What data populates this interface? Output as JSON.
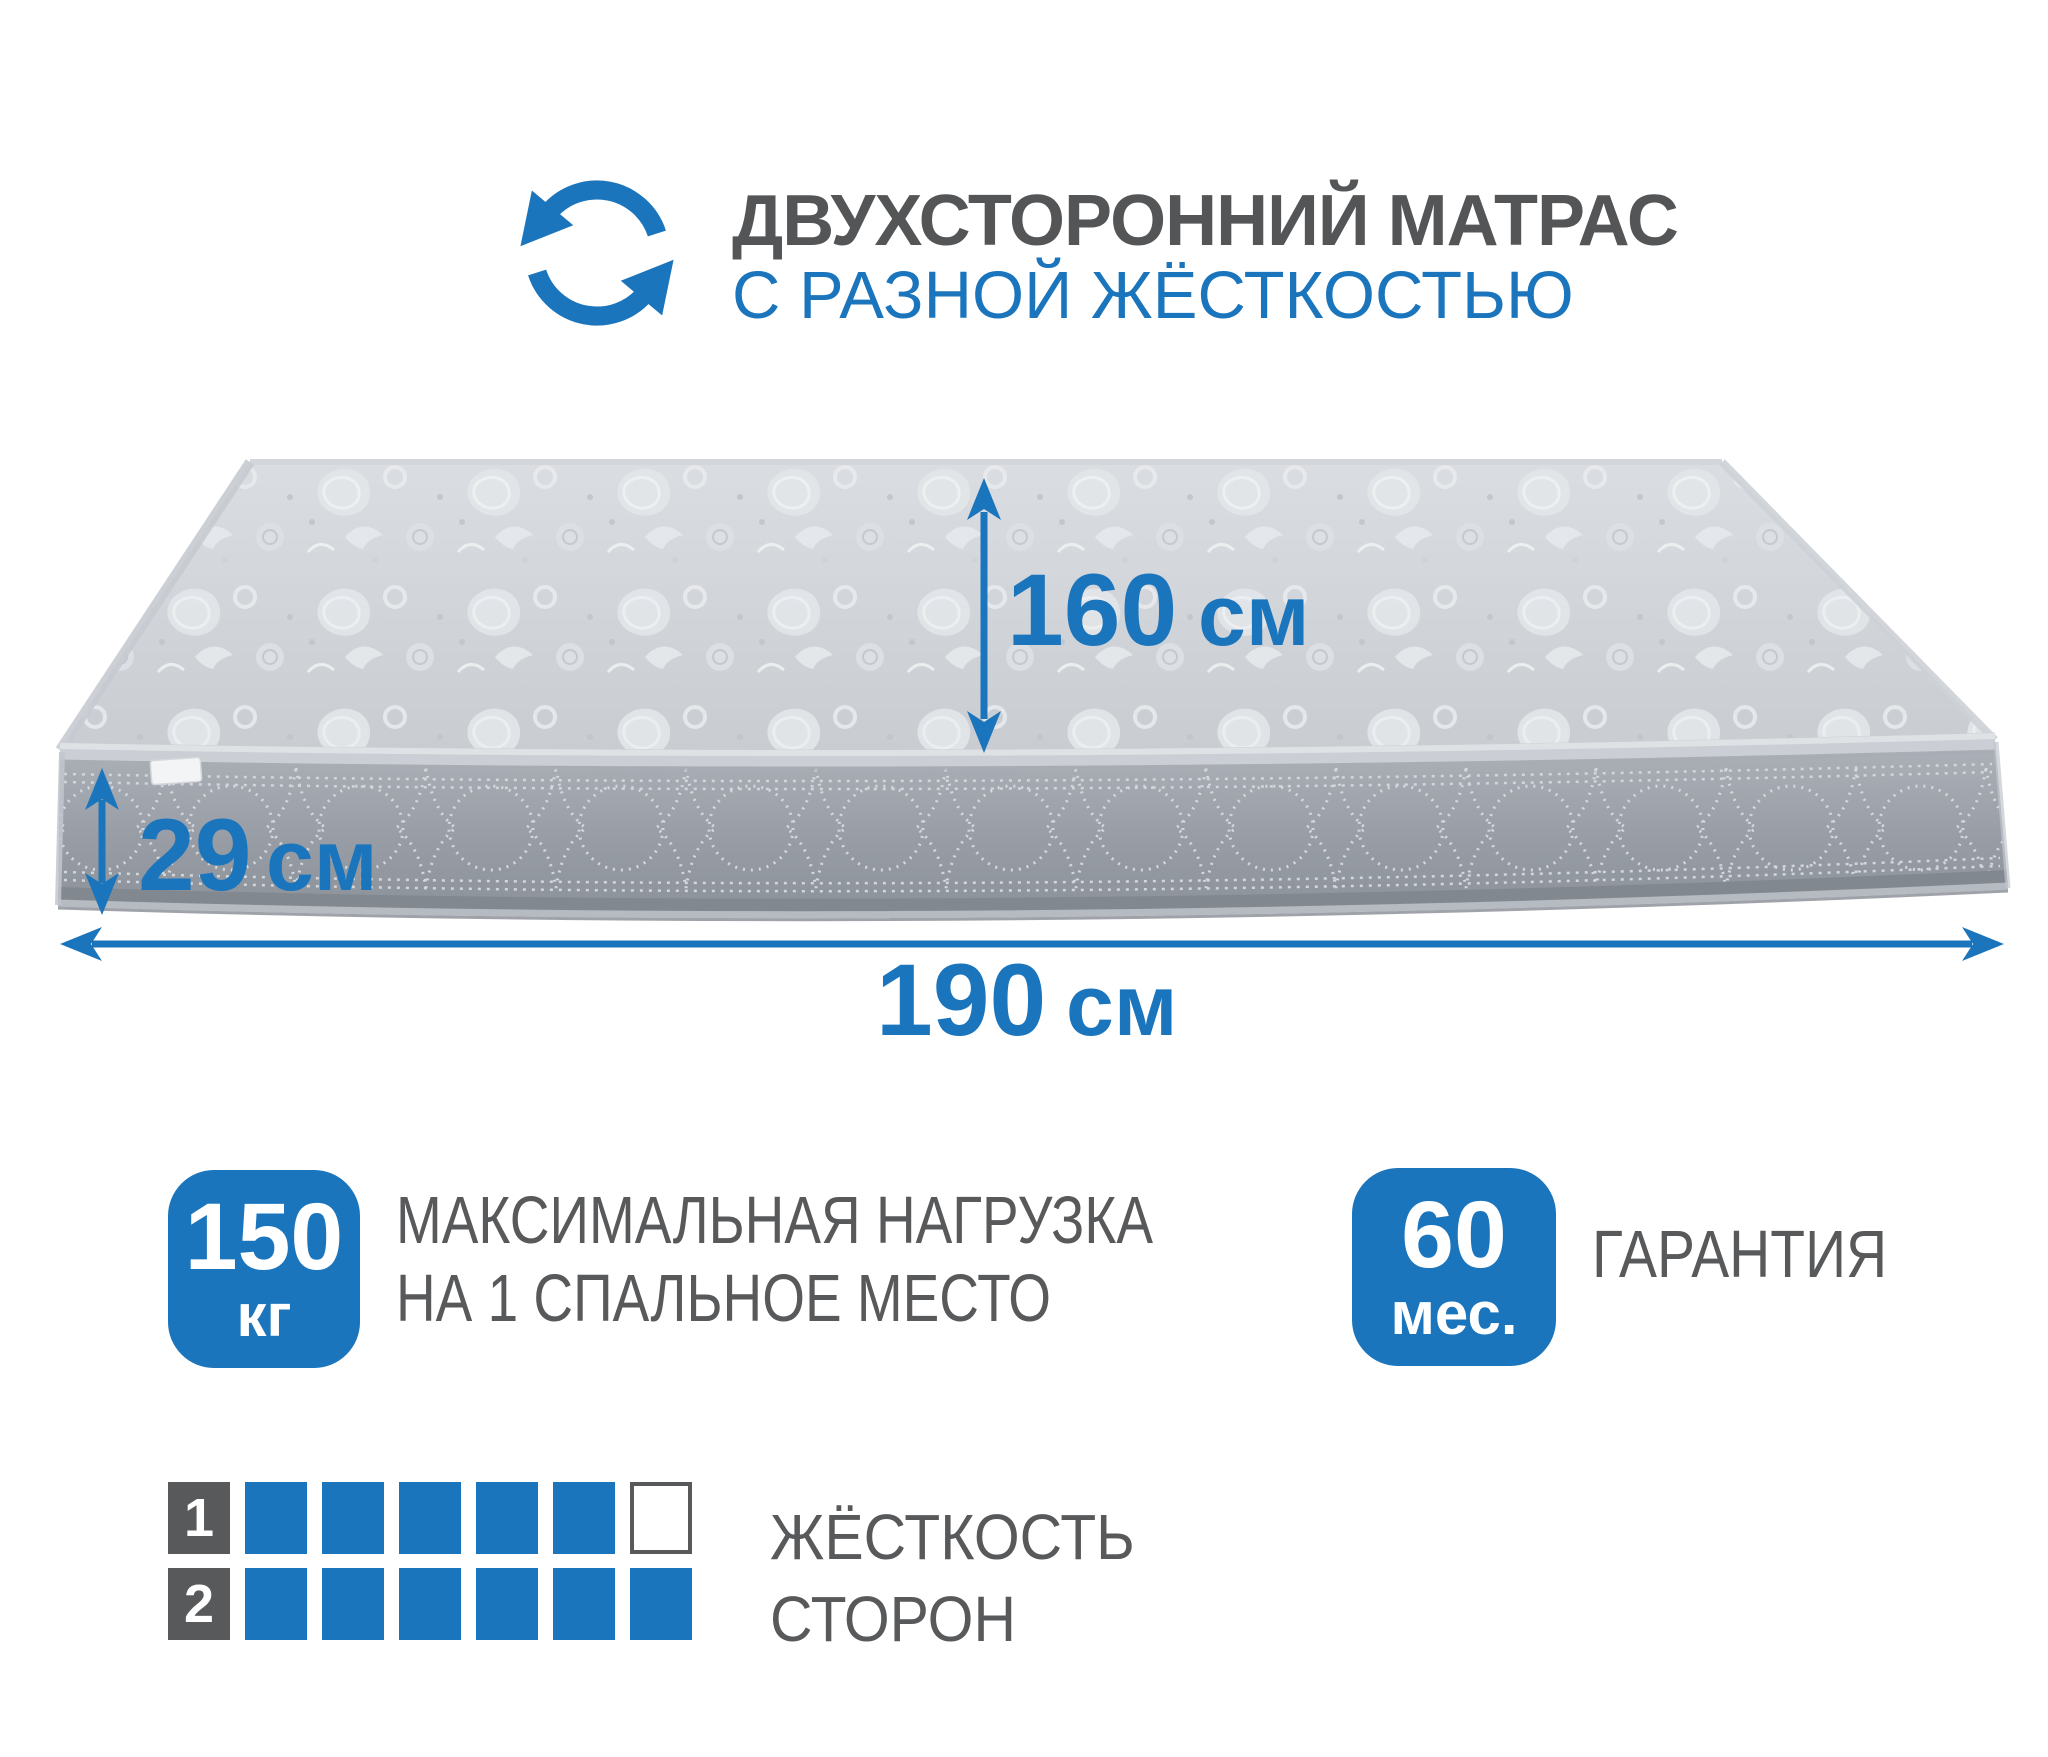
{
  "header": {
    "title": "ДВУХСТОРОННИЙ МАТРАС",
    "subtitle": "С РАЗНОЙ ЖЁСТКОСТЬЮ"
  },
  "icons": {
    "header_icon": "rotate-two-arrows-icon"
  },
  "dimensions": {
    "width": {
      "value": "160",
      "unit": "см"
    },
    "height": {
      "value": "29",
      "unit": "см"
    },
    "length": {
      "value": "190",
      "unit": "см"
    }
  },
  "badges": {
    "max_load": {
      "value": "150",
      "unit": "кг",
      "caption_line1": "МАКСИМАЛЬНАЯ НАГРУЗКА",
      "caption_line2": "НА 1 СПАЛЬНОЕ МЕСТО"
    },
    "warranty": {
      "value": "60",
      "unit": "мес.",
      "caption": "ГАРАНТИЯ"
    }
  },
  "firmness": {
    "caption_line1": "ЖЁСТКОСТЬ",
    "caption_line2": "СТОРОН",
    "rows": [
      {
        "label": "1",
        "filled": 5,
        "total": 6
      },
      {
        "label": "2",
        "filled": 6,
        "total": 6
      }
    ]
  },
  "colors": {
    "accent": "#1b75bc",
    "text_gray": "#58595b",
    "title_gray": "#545557"
  }
}
